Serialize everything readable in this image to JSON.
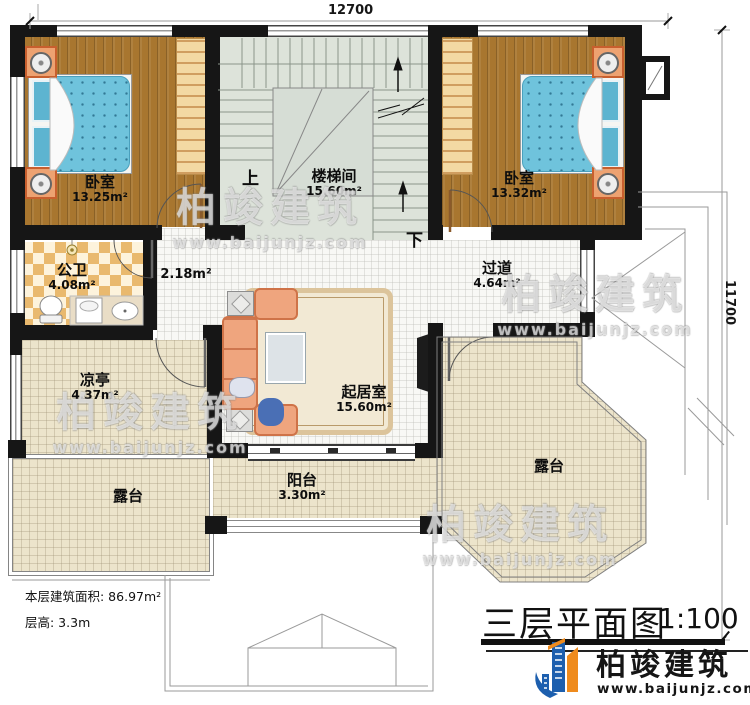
{
  "plan": {
    "dim_top": "12700",
    "dim_right": "11700",
    "stairs_up": "上",
    "stairs_down": "下",
    "rooms": {
      "bedroom1": {
        "name": "卧室",
        "area": "13.25m²"
      },
      "bedroom2": {
        "name": "卧室",
        "area": "13.32m²"
      },
      "stairwell": {
        "name": "楼梯间",
        "area": "15.60m²"
      },
      "bathroom": {
        "name": "公卫",
        "area": "4.08m²"
      },
      "hall": {
        "area": "2.18m²"
      },
      "corridor": {
        "name": "过道",
        "area": "4.64m²"
      },
      "pavilion": {
        "name": "凉亭",
        "area": "4.37m²"
      },
      "living_room": {
        "name": "起居室",
        "area": "15.60m²"
      },
      "balcony": {
        "name": "阳台",
        "area": "3.30m²"
      },
      "terrace_left": {
        "name": "露台"
      },
      "terrace_right": {
        "name": "露台"
      }
    }
  },
  "info": {
    "area_line": "本层建筑面积: 86.97m²",
    "height_line": "层高: 3.3m"
  },
  "title": {
    "name": "三层平面图",
    "scale": "1:100"
  },
  "brand": {
    "name": "柏竣建筑",
    "url": "www.baijunjz.com"
  },
  "watermark": {
    "name": "柏竣建筑",
    "url": "www.baijunjz.com"
  },
  "colors": {
    "wall": "#161616",
    "wood_floor": "#a8762f",
    "mattress_blue": "#6fc3dc",
    "tile_beige": "#ece4cb",
    "checker_orange": "#e9b96e",
    "stair_floor": "#dde3da",
    "brand_blue": "#1d5fae",
    "brand_orange": "#ef8b1d"
  }
}
